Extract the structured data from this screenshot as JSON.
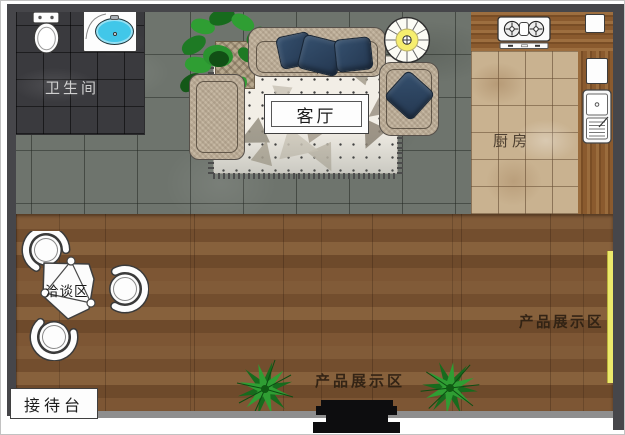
{
  "floorplan": {
    "type": "interior-floor-plan",
    "rooms": [
      {
        "id": "bathroom",
        "label": "卫生间"
      },
      {
        "id": "living-room",
        "label": "客厅"
      },
      {
        "id": "kitchen",
        "label": "厨房"
      },
      {
        "id": "negotiation-area",
        "label": "洽谈区"
      },
      {
        "id": "reception-desk",
        "label": "接待台"
      },
      {
        "id": "product-display-bottom",
        "label": "产品展示区"
      },
      {
        "id": "product-display-right",
        "label": "产品展示区"
      }
    ],
    "colors": {
      "wall": "#46464a",
      "bottom_wall": "#8e8e8e",
      "bathroom_floor": "#3a3a3e",
      "living_floor_marble": "#6e746d",
      "kitchen_tile": "#c9b290",
      "counter_wood": "#8a5a2e",
      "showroom_wood": "#7a5232",
      "accent_strip_yellow": "#ece96b",
      "pillow_navy": "#2b3f57",
      "sofa_beige": "#c6b8a3",
      "plant_green": "#2f9e33",
      "basin_blue": "#41c7e9",
      "staircase_yellow": "#f6ee6e"
    }
  }
}
